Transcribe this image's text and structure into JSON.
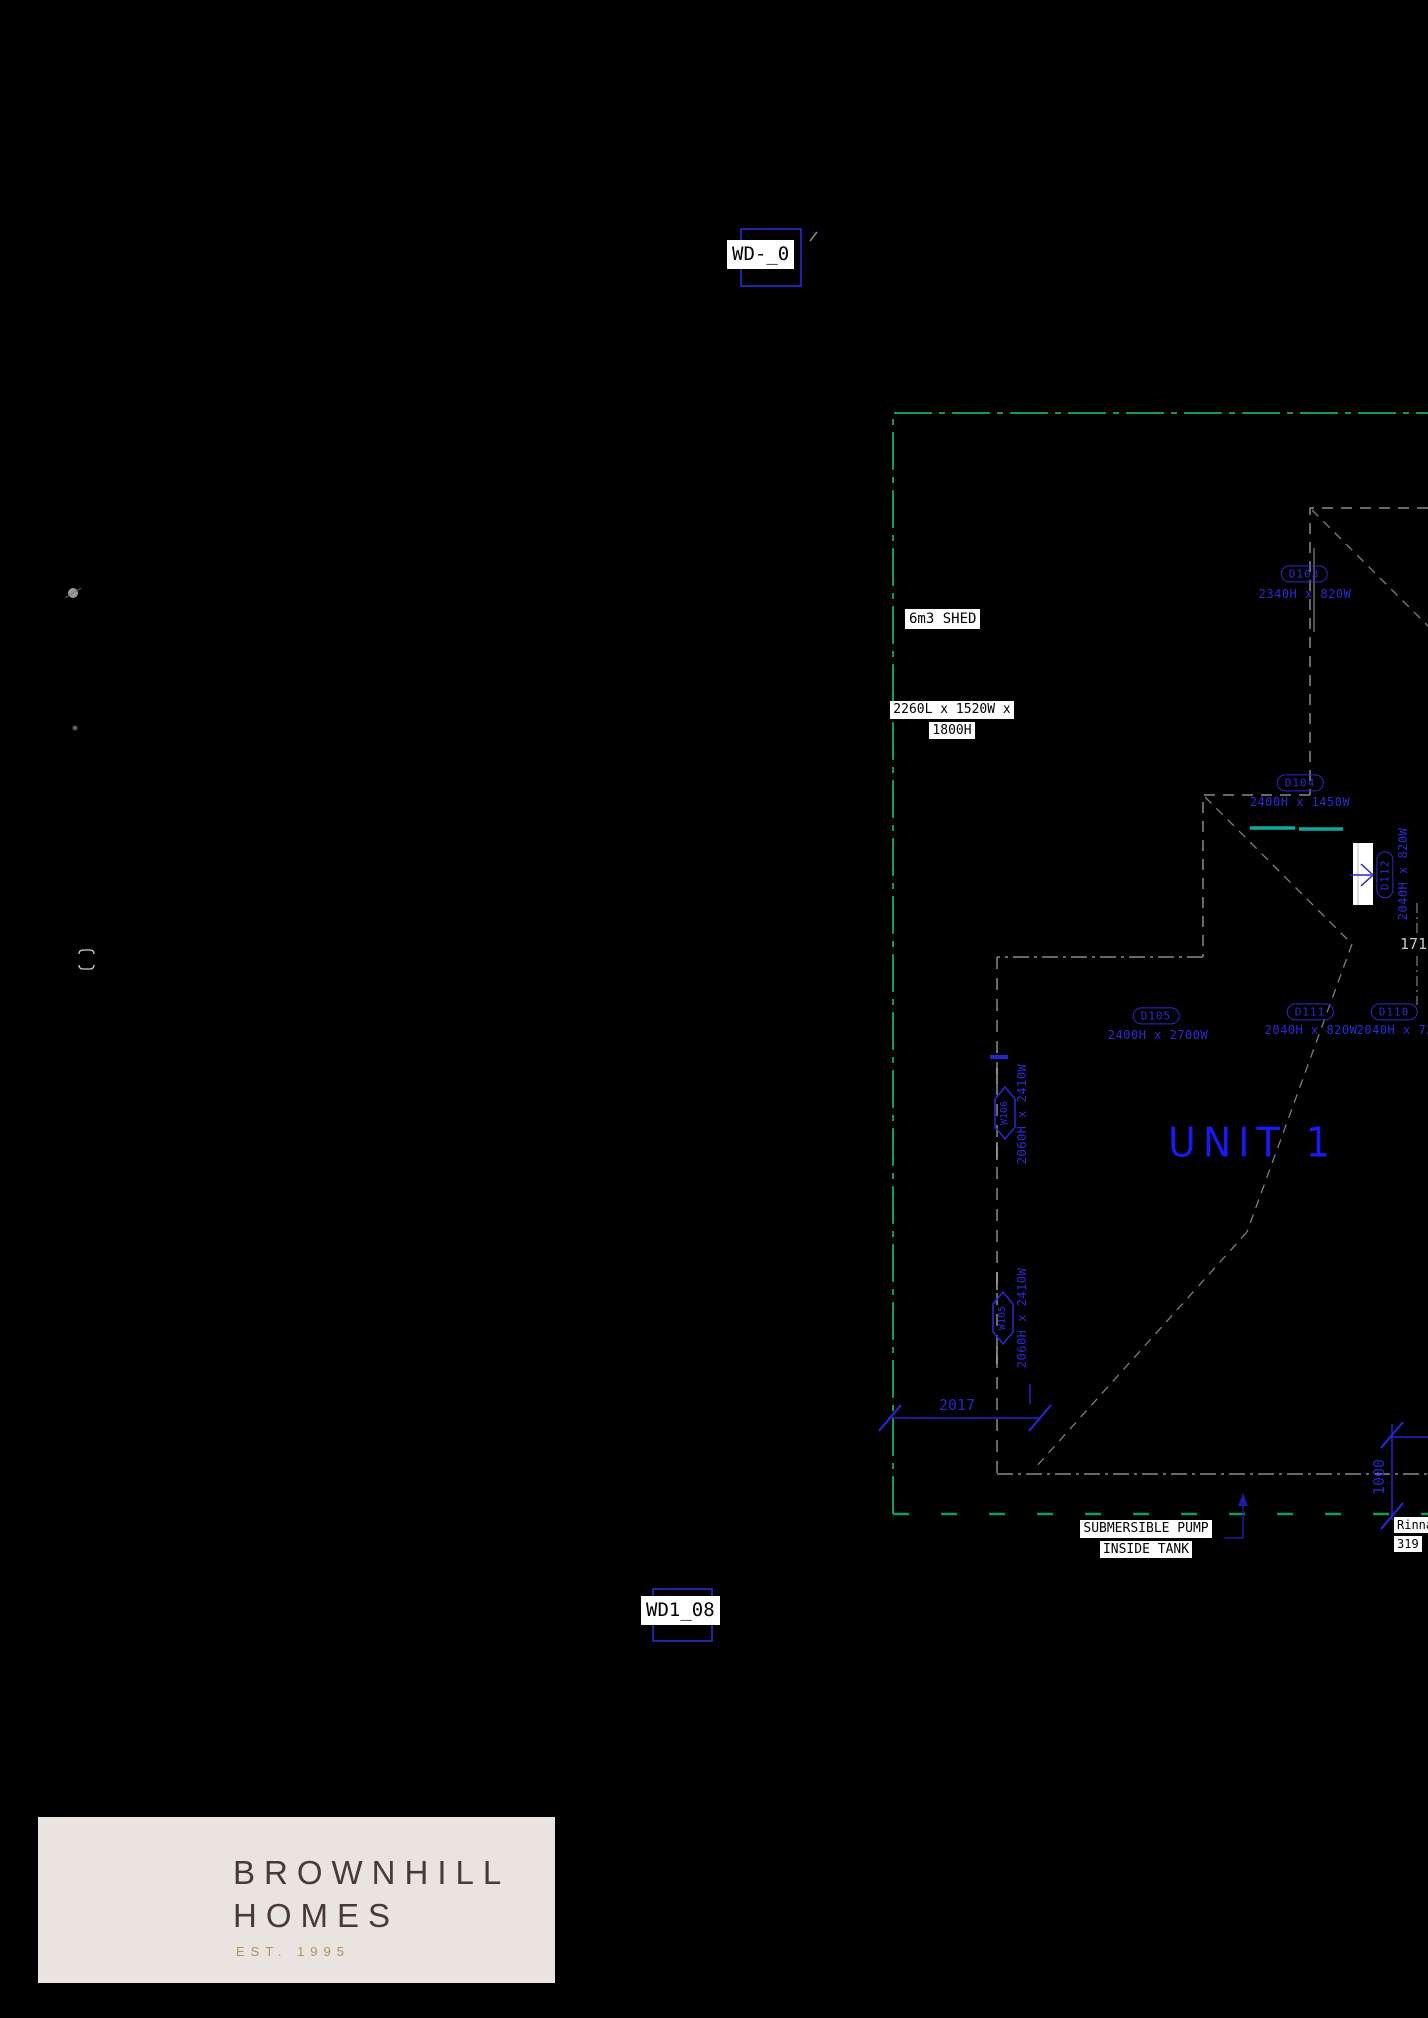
{
  "drawing": {
    "markers": {
      "top": "WD-_0",
      "bottom": "WD1_08"
    },
    "shed": {
      "name": "6m3 SHED",
      "size_line1": "2260L x 1520W x",
      "size_line2": "1800H"
    },
    "unit_label": "UNIT 1",
    "notes": {
      "pump_line1": "SUBMERSIBLE PUMP",
      "pump_line2": "INSIDE TANK",
      "edge_line1": "Rinnai",
      "edge_line2": "319"
    },
    "doors": [
      {
        "id": "D103",
        "size": "2340H x 820W"
      },
      {
        "id": "D104",
        "size": "2400H x 1450W"
      },
      {
        "id": "D105",
        "size": "2400H x 2700W"
      },
      {
        "id": "D111",
        "size": "2040H x 820W"
      },
      {
        "id": "D110",
        "size": "2040H x 720W"
      },
      {
        "id": "D112",
        "size": "2040H x 820W"
      }
    ],
    "windows": [
      {
        "id": "W106",
        "size": "2060H x 2410W"
      },
      {
        "id": "W105",
        "size": "2060H x 2410W"
      }
    ],
    "dimensions": {
      "width": "2017",
      "height": "1000",
      "right": "1710"
    },
    "colors": {
      "boundary_green": "#0f9d4e",
      "outline_grey": "#8a8a8a",
      "label_blue": "#2b2bd6",
      "dim_blue": "#2525cc",
      "teal": "#0fa8a0"
    }
  },
  "logo": {
    "monogram": "BH",
    "brand_line1": "BROWNHILL",
    "brand_line2": "HOMES",
    "established": "EST. 1995"
  }
}
